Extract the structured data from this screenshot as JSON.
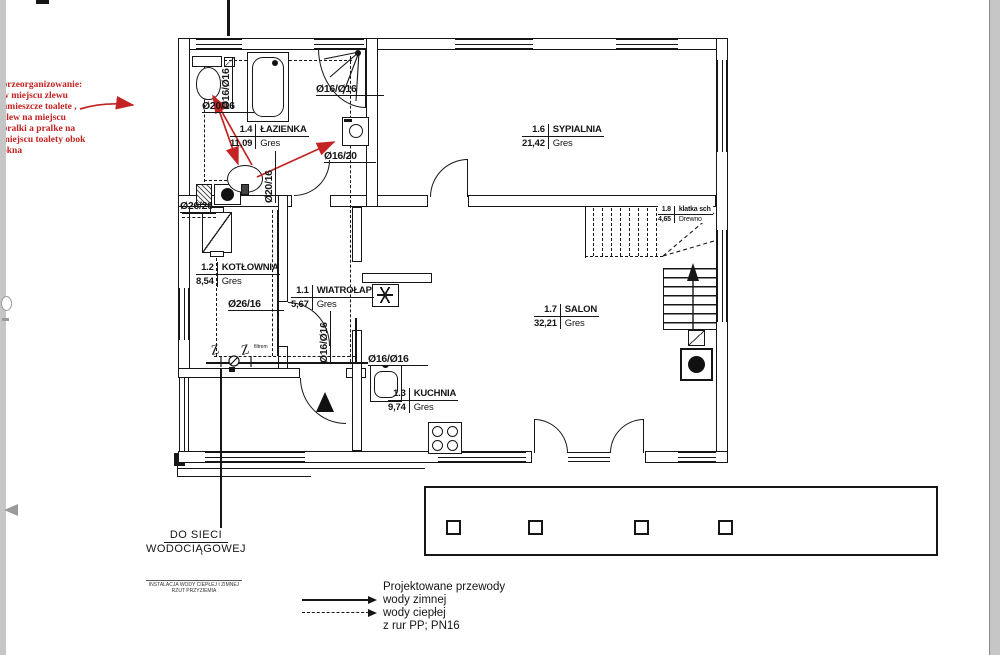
{
  "annotation": {
    "text": "przeorganizowanie:\nw miejscu zlewu\numieszcze toalete ,\nzlew na miejscu\npralki a pralke na\nmiejscu toalety obok\nokna",
    "color": "#c42323"
  },
  "rooms": [
    {
      "num": "1.4",
      "name": "ŁAZIENKA",
      "area": "11,09",
      "floor": "Gres"
    },
    {
      "num": "1.6",
      "name": "SYPIALNIA",
      "area": "21,42",
      "floor": "Gres"
    },
    {
      "num": "1.2",
      "name": "KOTŁOWNIA",
      "area": "8,54",
      "floor": "Gres"
    },
    {
      "num": "1.1",
      "name": "WIATROŁAP",
      "area": "5,67",
      "floor": "Gres"
    },
    {
      "num": "1.7",
      "name": "SALON",
      "area": "32,21",
      "floor": "Gres"
    },
    {
      "num": "1.8",
      "name": "klatka sch",
      "area": "4,65",
      "floor": "Drewno"
    },
    {
      "num": "1.3",
      "name": "KUCHNIA",
      "area": "9,74",
      "floor": "Gres"
    }
  ],
  "pipe_labels": [
    {
      "text": "Ø20/16"
    },
    {
      "text": "Ø16/Ø16"
    },
    {
      "text": "Ø16/Ø16"
    },
    {
      "text": "Ø16/20"
    },
    {
      "text": "Ø20/16"
    },
    {
      "text": "Ø26/26"
    },
    {
      "text": "Ø26/16"
    },
    {
      "text": "Ø16/Ø16"
    },
    {
      "text": "Ø16/Ø16"
    }
  ],
  "symbols": {
    "valve": "Z"
  },
  "notes": {
    "filter": "filtrem"
  },
  "water_main": {
    "line1": "DO SIECI",
    "line2": "WODOCIĄGOWEJ"
  },
  "stamp": {
    "line1": "INSTALACJA WODY CIEPŁEJ I ZIMNEJ",
    "line2": "RZUT PRZYZIEMIA"
  },
  "legend": {
    "title": "Projektowane przewody",
    "items": [
      {
        "label": "wody zimnej",
        "style": "solid"
      },
      {
        "label": "wody ciepłej",
        "style": "dashed"
      }
    ],
    "note": "z rur PP; PN16"
  },
  "colors": {
    "ink": "#161616",
    "red": "#c42323",
    "paper": "#ffffff",
    "scan_edge": "#c6c6c6"
  }
}
